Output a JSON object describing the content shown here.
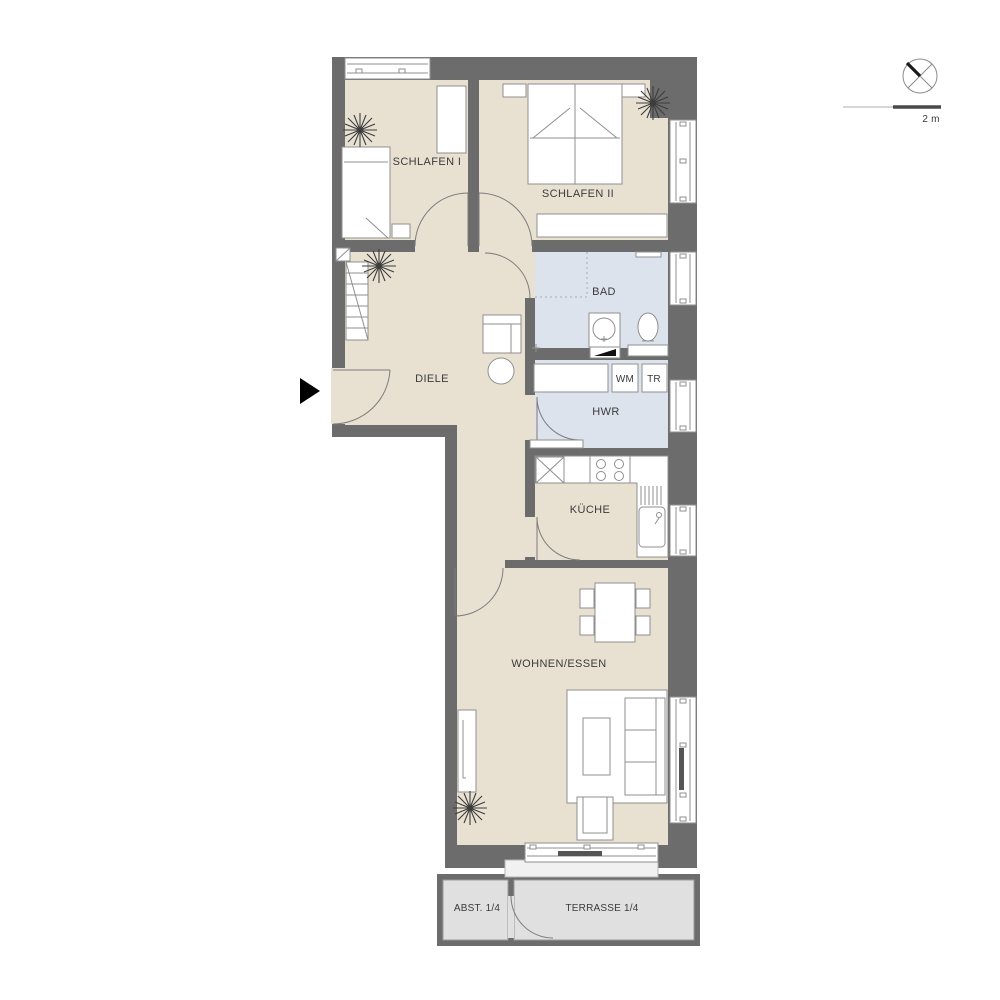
{
  "page": {
    "background": "#ffffff"
  },
  "colors": {
    "wall": "#6c6c6c",
    "floor": "#e8e1d2",
    "wet": "#dce3ec",
    "terrace": "#e0e0e0",
    "line": "#8f8f8f",
    "door-line": "#7c7c7c",
    "text": "#3b3b3b",
    "accent-dark": "#4a4a4a"
  },
  "rooms": [
    {
      "id": "schlafen-1",
      "label": "SCHLAFEN I"
    },
    {
      "id": "schlafen-2",
      "label": "SCHLAFEN II"
    },
    {
      "id": "bad",
      "label": "BAD"
    },
    {
      "id": "diele",
      "label": "DIELE"
    },
    {
      "id": "hwr",
      "label": "HWR"
    },
    {
      "id": "kueche",
      "label": "KÜCHE"
    },
    {
      "id": "wohnen-essen",
      "label": "WOHNEN/ESSEN"
    },
    {
      "id": "abstellraum",
      "label": "ABST. 1/4"
    },
    {
      "id": "terrasse",
      "label": "TERRASSE 1/4"
    }
  ],
  "appliances": [
    {
      "id": "waschmaschine",
      "label": "WM"
    },
    {
      "id": "trockner",
      "label": "TR"
    }
  ],
  "legend": {
    "scale_label": "2 m"
  },
  "icons": {
    "north": "north-compass-icon",
    "entrance": "entrance-arrow-icon",
    "plant": "plant-icon"
  }
}
